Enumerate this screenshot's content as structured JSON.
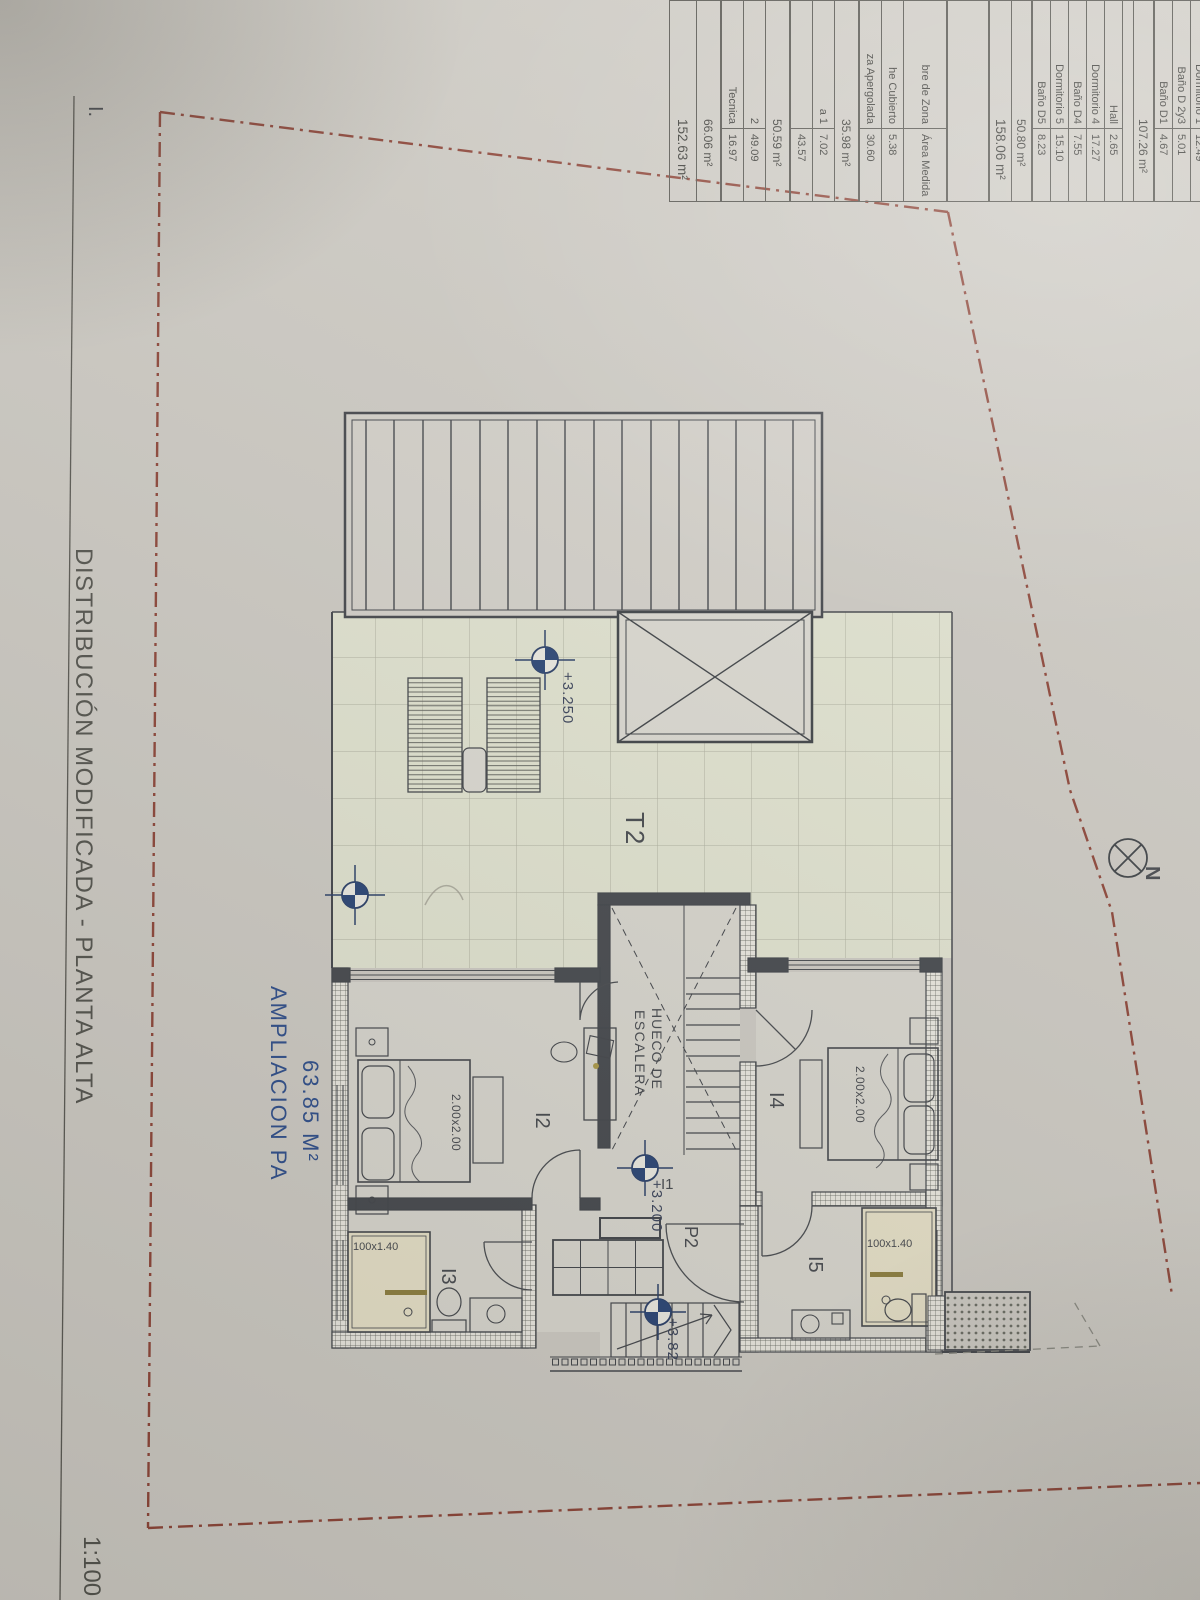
{
  "sheet": {
    "title": "DISTRIBUCIÓN MODIFICADA - PLANTA ALTA",
    "scale_label": "1:100",
    "corner_label": "I.",
    "north_label": "N"
  },
  "plan": {
    "annotation": {
      "label": "AMPLIACION PA",
      "area": "63.85 M²"
    },
    "rooms": {
      "terrace": "T2",
      "room_i1": "I1",
      "room_i2": "I2",
      "room_i3": "I3",
      "room_i4": "I4",
      "room_i5": "I5",
      "door_p2": "P2",
      "stair_line1": "HUECO DE",
      "stair_line2": "ESCALERA"
    },
    "levels": {
      "terrace_upper": "+3.250",
      "terrace_lower": "+3.185",
      "landing": "+3.200",
      "stair": "+3.82"
    },
    "dimensions": {
      "bed_i2": "2.00x2.00",
      "bed_i4": "2.00x2.00",
      "shower_i3": "100x1.40",
      "shower_i5": "100x1.40"
    }
  },
  "area_table": {
    "col_name_header": "bre de Zona",
    "col_value_header": "Área Medida",
    "upper_rows": [
      {
        "name": "Dormitorio 1",
        "value": "12.49",
        "type": "row"
      },
      {
        "name": "Baño D 2y3",
        "value": "5.01",
        "type": "row"
      },
      {
        "name": "Baño D1",
        "value": "4.67",
        "type": "row"
      },
      {
        "name": "",
        "value": "107.26 m²",
        "type": "total"
      },
      {
        "name": "",
        "value": "",
        "type": "spacer"
      },
      {
        "name": "Hall",
        "value": "2.65",
        "type": "row"
      },
      {
        "name": "Dormitorio 4",
        "value": "17.27",
        "type": "row"
      },
      {
        "name": "Baño D4",
        "value": "7.55",
        "type": "row"
      },
      {
        "name": "Dormitorio 5",
        "value": "15.10",
        "type": "row"
      },
      {
        "name": "Baño D5",
        "value": "8.23",
        "type": "row"
      },
      {
        "name": "",
        "value": "50.80 m²",
        "type": "total"
      },
      {
        "name": "",
        "value": "158.06 m²",
        "type": "grand"
      }
    ],
    "lower_rows": [
      {
        "name": "he Cubierto",
        "value": "5.38",
        "type": "row"
      },
      {
        "name": "za Apergolada",
        "value": "30.60",
        "type": "row"
      },
      {
        "name": "",
        "value": "35.98 m²",
        "type": "total"
      },
      {
        "name": "a 1",
        "value": "7.02",
        "type": "row"
      },
      {
        "name": "",
        "value": "43.57",
        "type": "row"
      },
      {
        "name": "",
        "value": "50.59 m²",
        "type": "total"
      },
      {
        "name": "2",
        "value": "49.09",
        "type": "row"
      },
      {
        "name": "Tecnica",
        "value": "16.97",
        "type": "row"
      },
      {
        "name": "",
        "value": "66.06 m²",
        "type": "total"
      },
      {
        "name": "",
        "value": "152.63 m²",
        "type": "grand"
      }
    ]
  },
  "colors": {
    "accent_blue": "#2f4f8c",
    "boundary_red": "#8f4639",
    "line_dark": "#44474c",
    "terrace_green": "#e4e6d3",
    "shower_cream": "#e9e3ca"
  }
}
